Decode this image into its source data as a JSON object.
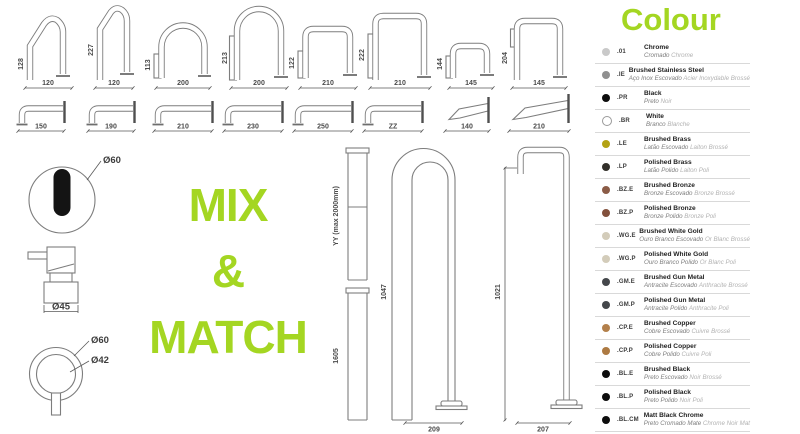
{
  "colors": {
    "accent": "#a4d622",
    "line": "#7d7d7d"
  },
  "mix_match": {
    "line1": "MIX",
    "line2": "&",
    "line3": "MATCH"
  },
  "top_spouts": [
    {
      "h": "128",
      "w": "120"
    },
    {
      "h": "227",
      "w": "120"
    },
    {
      "h": "113",
      "w": "200"
    },
    {
      "h": "213",
      "w": "200"
    },
    {
      "h": "122",
      "w": "210"
    },
    {
      "h": "222",
      "w": "210"
    },
    {
      "h": "144",
      "w": "145"
    },
    {
      "h": "204",
      "w": "145"
    }
  ],
  "wall_spouts": [
    {
      "w": "150"
    },
    {
      "w": "190"
    },
    {
      "w": "210"
    },
    {
      "w": "230"
    },
    {
      "w": "250"
    },
    {
      "w": "ZZ"
    },
    {
      "w": "140"
    },
    {
      "w": "210"
    }
  ],
  "details": {
    "sensor_dia": "Ø60",
    "body_dia": "Ø45",
    "ring_outer": "Ø60",
    "ring_inner": "Ø42"
  },
  "columns": {
    "col1_label": "YY (max 2000mm)",
    "col2_label": "1605",
    "floor1_h": "1047",
    "floor1_w": "209",
    "floor2_h": "1021",
    "floor2_w": "207"
  },
  "legend": {
    "title": "Colour",
    "rows": [
      {
        "code": ".01",
        "name": "Chrome",
        "pt": "Cromado",
        "fr": "Chrome",
        "color": "#c9c9c9",
        "outline": false
      },
      {
        "code": ".IE",
        "name": "Brushed Stainless Steel",
        "pt": "Aço Inox Escovado",
        "fr": "Acier Inoxydable Brossé",
        "color": "#909090",
        "outline": false
      },
      {
        "code": ".PR",
        "name": "Black",
        "pt": "Preto",
        "fr": "Noir",
        "color": "#0d0d0d",
        "outline": false
      },
      {
        "code": ".BR",
        "name": "White",
        "pt": "Branco",
        "fr": "Blanche",
        "color": "#ffffff",
        "outline": true
      },
      {
        "code": ".LE",
        "name": "Brushed Brass",
        "pt": "Latão Escovado",
        "fr": "Laiton Brossé",
        "color": "#b3a214",
        "outline": false
      },
      {
        "code": ".LP",
        "name": "Polished Brass",
        "pt": "Latão Polido",
        "fr": "Laiton Poli",
        "color": "#32302a",
        "outline": false
      },
      {
        "code": ".BZ.E",
        "name": "Brushed Bronze",
        "pt": "Bronze Escovado",
        "fr": "Bronze Brossé",
        "color": "#8b5c47",
        "outline": false
      },
      {
        "code": ".BZ.P",
        "name": "Polished Bronze",
        "pt": "Bronze Polido",
        "fr": "Bronze Poli",
        "color": "#82503c",
        "outline": false
      },
      {
        "code": ".WG.E",
        "name": "Brushed White Gold",
        "pt": "Ouro Branco Escovado",
        "fr": "Or Blanc Brossé",
        "color": "#d3ccba",
        "outline": false
      },
      {
        "code": ".WG.P",
        "name": "Polished White Gold",
        "pt": "Ouro Branco Polido",
        "fr": "Or Blanc Poli",
        "color": "#d3ccba",
        "outline": false
      },
      {
        "code": ".GM.E",
        "name": "Brushed Gun Metal",
        "pt": "Antracite Escovado",
        "fr": "Anthracite Brossé",
        "color": "#44474b",
        "outline": false
      },
      {
        "code": ".GM.P",
        "name": "Polished Gun Metal",
        "pt": "Antracite Polido",
        "fr": "Anthracite Poli",
        "color": "#44474b",
        "outline": false
      },
      {
        "code": ".CP.E",
        "name": "Brushed Copper",
        "pt": "Cobre Escovado",
        "fr": "Cuivre Brossé",
        "color": "#b3804b",
        "outline": false
      },
      {
        "code": ".CP.P",
        "name": "Polished Copper",
        "pt": "Cobre Polido",
        "fr": "Cuivre Poli",
        "color": "#ad7a42",
        "outline": false
      },
      {
        "code": ".BL.E",
        "name": "Brushed Black",
        "pt": "Preto Escovado",
        "fr": "Noir Brossé",
        "color": "#0d0d0d",
        "outline": false
      },
      {
        "code": ".BL.P",
        "name": "Polished Black",
        "pt": "Preto Polido",
        "fr": "Noir Poli",
        "color": "#0d0d0d",
        "outline": false
      },
      {
        "code": ".BL.CM",
        "name": "Matt Black Chrome",
        "pt": "Preto Cromado Mate",
        "fr": "Chrome Noir Mat",
        "color": "#0d0d0d",
        "outline": false
      }
    ]
  }
}
